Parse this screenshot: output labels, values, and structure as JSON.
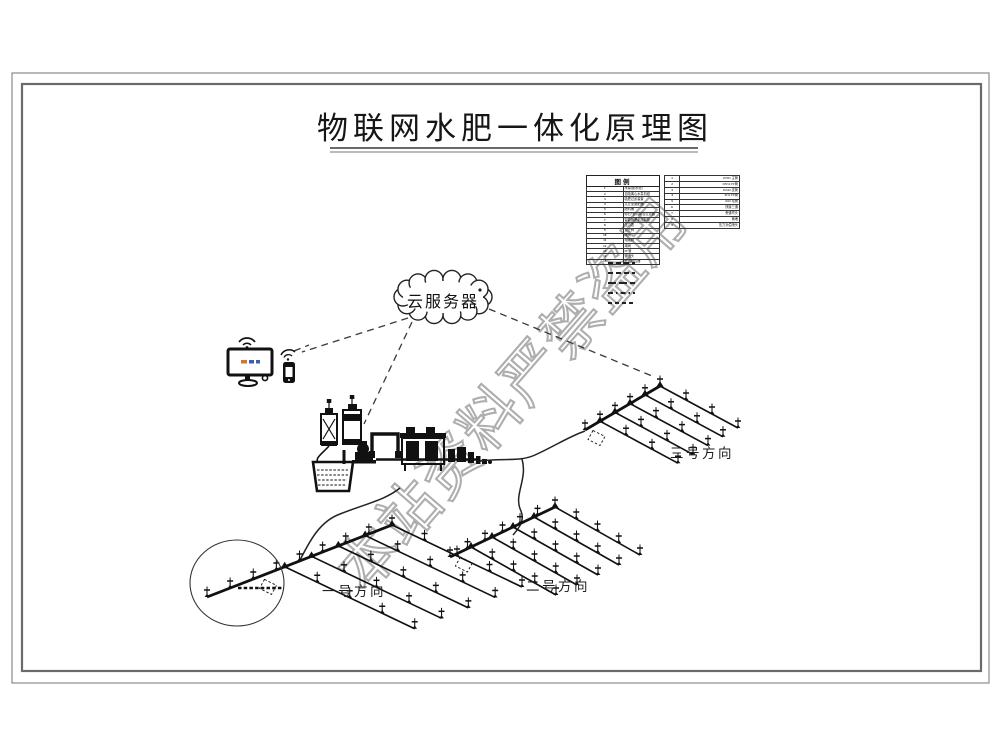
{
  "title": "物联网水肥一体化原理图",
  "cloud": {
    "label": "云服务器"
  },
  "legend": {
    "title": "图例",
    "left_rows": [
      {
        "no": "1",
        "label": "水源(蓄水池)"
      },
      {
        "no": "2",
        "label": "自吸离心水泵机组"
      },
      {
        "no": "3",
        "label": "吸肥过滤装置"
      },
      {
        "no": "4",
        "label": "文丘里施肥器"
      },
      {
        "no": "5",
        "label": "肥料桶"
      },
      {
        "no": "6",
        "label": "砂石+叠片组合过滤器"
      },
      {
        "no": "7",
        "label": "智能施肥机控制柜"
      },
      {
        "no": "8",
        "label": "压力表"
      },
      {
        "no": "9",
        "label": "逆止阀"
      },
      {
        "no": "10",
        "label": "闸阀"
      },
      {
        "no": "11",
        "label": "电磁阀"
      },
      {
        "no": "12",
        "label": "球阀"
      },
      {
        "no": "13",
        "label": "PE管"
      },
      {
        "no": "14",
        "label": "微喷头"
      },
      {
        "no": "15",
        "label": "无线阀控器"
      }
    ],
    "right_rows": [
      {
        "no": "1",
        "label": "DN65 主管"
      },
      {
        "no": "2",
        "label": "DN50 PE管"
      },
      {
        "no": "3",
        "label": "DN40 支管"
      },
      {
        "no": "4",
        "label": "Φ32 PE管"
      },
      {
        "no": "5",
        "label": "Φ20 毛管"
      },
      {
        "no": "6",
        "label": "快接三通"
      },
      {
        "no": "7",
        "label": "旁通弯头"
      },
      {
        "no": "8",
        "label": "管堵"
      },
      {
        "no": "9",
        "label": "压力补偿喷头"
      }
    ],
    "line_samples": [
      "dashed",
      "dashed",
      "long-dash",
      "dash-dot",
      "dashed"
    ]
  },
  "fields": [
    {
      "label": "一号方向"
    },
    {
      "label": "二号方向"
    },
    {
      "label": "三号方向"
    }
  ],
  "watermark": "本站资料严禁盗用",
  "icons": {
    "cloud": "cloud-shape",
    "monitor": "monitor-wifi-icon",
    "phone": "mobile-wifi-icon",
    "water_basin": "water-basin-icon",
    "pump": "pump-icon",
    "fertilizer_tanks": "fertilizer-tank-icon",
    "filter_unit": "filter-frame-icon",
    "sprinkler": "sprinkler-icon"
  }
}
